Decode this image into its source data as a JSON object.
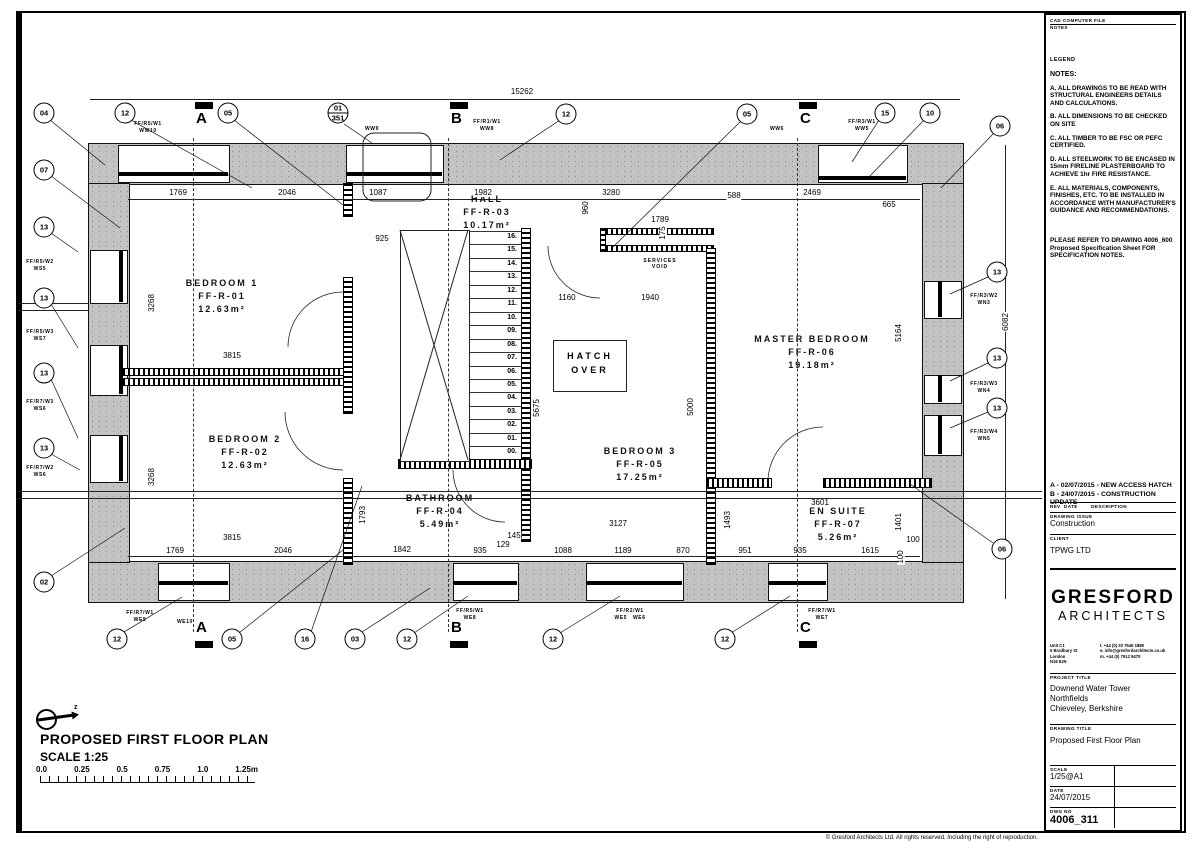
{
  "footer": "© Gresford Architects Ltd.  All rights reserved.  Including the right of reproduction.",
  "panel": {
    "file_label": "CAD COMPUTER FILE",
    "file_sub": "NOTES",
    "legend": "LEGEND",
    "notes_heading": "NOTES:",
    "notes": [
      "A. ALL DRAWINGS TO  BE READ WITH STRUCTURAL ENGINEERS DETAILS AND CALCULATIONS.",
      "B. ALL DIMENSIONS TO BE CHECKED ON SITE",
      "C. ALL TIMBER TO BE FSC OR PEFC CERTIFIED.",
      "D. ALL STEELWORK TO BE ENCASED IN 15mm FIRELINE PLASTERBOARD TO ACHIEVE 1hr FIRE RESISTANCE.",
      "E. ALL MATERIALS, COMPONENTS, FINISHES, ETC. TO BE INSTALLED IN ACCORDANCE WITH MANUFACTURER'S GUIDANCE AND RECOMMENDATIONS."
    ],
    "refer": "PLEASE REFER TO DRAWING 4006_600 Proposed Specification Sheet FOR SPECIFICATION NOTES.",
    "revisions": [
      "A - 02/07/2015 - NEW ACCESS HATCH",
      "B - 24/07/2015 - CONSTRUCTION  UPDATE"
    ],
    "rev_header": "REV  DATE        DESCRIPTION",
    "issue_label": "DRAWING ISSUE",
    "issue_value": "Construction",
    "client_label": "CLIENT",
    "client_value": "TPWG LTD",
    "brand_line1": "GRESFORD",
    "brand_line2": "ARCHITECTS",
    "address": [
      "Unit C1",
      "5 Bradbury St",
      "London",
      "N16 8JN"
    ],
    "contact": [
      "t.   +44 (0) 20 7549 1888",
      "e.   info@gresfordarchitects.co.uk",
      "m.  +44 (0) 7912 9470"
    ],
    "project_label": "PROJECT  TITLE",
    "project": [
      "Downend Water Tower",
      "Northfields",
      "Chieveley, Berkshire"
    ],
    "drawing_label": "DRAWING  TITLE",
    "drawing_value": "Proposed First Floor Plan",
    "scale_label": "SCALE",
    "scale_value": "1/25@A1",
    "drawn_label": "DRAWN",
    "drawn_value": "TG",
    "date_label": "DATE",
    "date_value": "24/07/2015",
    "checked_label": "CHECKED",
    "checked_value": "TG",
    "dwg_label": "DWG  NO",
    "dwg_value": "4006_311",
    "revision_label": "REVISION",
    "revision_value": "B"
  },
  "plan": {
    "title": "PROPOSED FIRST FLOOR PLAN",
    "scale": "SCALE 1:25",
    "scalebar": [
      "0.0",
      "0.25",
      "0.5",
      "0.75",
      "1.0",
      "1.25m"
    ],
    "hatch_over": [
      "HATCH",
      "OVER"
    ],
    "services_void": [
      "SERVICES",
      "VOID"
    ],
    "rooms": [
      {
        "name": "BEDROOM 1",
        "id": "FF-R-01",
        "area": "12.63m²",
        "x": 222,
        "y": 277
      },
      {
        "name": "BEDROOM 2",
        "id": "FF-R-02",
        "area": "12.63m²",
        "x": 245,
        "y": 433
      },
      {
        "name": "HALL",
        "id": "FF-R-03",
        "area": "10.17m²",
        "x": 487,
        "y": 193
      },
      {
        "name": "BATHROOM",
        "id": "FF-R-04",
        "area": "5.49m²",
        "x": 440,
        "y": 492
      },
      {
        "name": "BEDROOM 3",
        "id": "FF-R-05",
        "area": "17.25m²",
        "x": 640,
        "y": 445
      },
      {
        "name": "MASTER BEDROOM",
        "id": "FF-R-06",
        "area": "19.18m²",
        "x": 812,
        "y": 333
      },
      {
        "name": "EN SUITE",
        "id": "FF-R-07",
        "area": "5.26m²",
        "x": 838,
        "y": 505
      }
    ],
    "stairs": [
      "16.",
      "15.",
      "14.",
      "13.",
      "12.",
      "11.",
      "10.",
      "09.",
      "08.",
      "07.",
      "06.",
      "05.",
      "04.",
      "03.",
      "02.",
      "01.",
      "00."
    ],
    "dims": [
      {
        "v": "15262",
        "x": 522,
        "y": 92
      },
      {
        "v": "1769",
        "x": 178,
        "y": 193
      },
      {
        "v": "2046",
        "x": 287,
        "y": 193
      },
      {
        "v": "1087",
        "x": 378,
        "y": 193
      },
      {
        "v": "1982",
        "x": 483,
        "y": 193
      },
      {
        "v": "3280",
        "x": 611,
        "y": 193
      },
      {
        "v": "588",
        "x": 734,
        "y": 196
      },
      {
        "v": "2469",
        "x": 812,
        "y": 193
      },
      {
        "v": "665",
        "x": 889,
        "y": 205
      },
      {
        "v": "925",
        "x": 382,
        "y": 239
      },
      {
        "v": "1789",
        "x": 660,
        "y": 220
      },
      {
        "v": "1160",
        "x": 567,
        "y": 298
      },
      {
        "v": "1940",
        "x": 650,
        "y": 298
      },
      {
        "v": "3815",
        "x": 232,
        "y": 356
      },
      {
        "v": "3815",
        "x": 232,
        "y": 538
      },
      {
        "v": "1769",
        "x": 175,
        "y": 551
      },
      {
        "v": "2046",
        "x": 283,
        "y": 551
      },
      {
        "v": "1842",
        "x": 402,
        "y": 550
      },
      {
        "v": "935",
        "x": 480,
        "y": 551
      },
      {
        "v": "129",
        "x": 503,
        "y": 545
      },
      {
        "v": "145",
        "x": 514,
        "y": 536
      },
      {
        "v": "1088",
        "x": 563,
        "y": 551
      },
      {
        "v": "1189",
        "x": 623,
        "y": 551
      },
      {
        "v": "870",
        "x": 683,
        "y": 551
      },
      {
        "v": "3127",
        "x": 618,
        "y": 524
      },
      {
        "v": "3601",
        "x": 820,
        "y": 503
      },
      {
        "v": "951",
        "x": 745,
        "y": 551
      },
      {
        "v": "935",
        "x": 800,
        "y": 551
      },
      {
        "v": "1615",
        "x": 870,
        "y": 551
      },
      {
        "v": "100",
        "x": 913,
        "y": 540
      },
      {
        "v": "960",
        "x": 586,
        "y": 208,
        "r": 1
      },
      {
        "v": "175",
        "x": 663,
        "y": 233,
        "r": 1
      },
      {
        "v": "3268",
        "x": 152,
        "y": 303,
        "r": 1
      },
      {
        "v": "3268",
        "x": 152,
        "y": 477,
        "r": 1
      },
      {
        "v": "5675",
        "x": 537,
        "y": 408,
        "r": 1
      },
      {
        "v": "5000",
        "x": 691,
        "y": 407,
        "r": 1
      },
      {
        "v": "5164",
        "x": 899,
        "y": 333,
        "r": 1
      },
      {
        "v": "6082",
        "x": 1006,
        "y": 322,
        "r": 1
      },
      {
        "v": "1793",
        "x": 363,
        "y": 515,
        "r": 1
      },
      {
        "v": "1493",
        "x": 728,
        "y": 520,
        "r": 1
      },
      {
        "v": "1401",
        "x": 899,
        "y": 522,
        "r": 1
      },
      {
        "v": "100",
        "x": 901,
        "y": 557,
        "r": 1
      }
    ],
    "callouts": [
      {
        "t": "04",
        "x": 44,
        "y": 113
      },
      {
        "t": "12",
        "x": 125,
        "y": 113
      },
      {
        "t": "05",
        "x": 228,
        "y": 113
      },
      {
        "t": "01",
        "b": "351",
        "x": 338,
        "y": 113
      },
      {
        "t": "12",
        "x": 566,
        "y": 114
      },
      {
        "t": "05",
        "x": 747,
        "y": 114
      },
      {
        "t": "15",
        "x": 885,
        "y": 113
      },
      {
        "t": "10",
        "x": 930,
        "y": 113
      },
      {
        "t": "06",
        "x": 1000,
        "y": 126
      },
      {
        "t": "07",
        "x": 44,
        "y": 170
      },
      {
        "t": "13",
        "x": 44,
        "y": 227
      },
      {
        "t": "13",
        "x": 44,
        "y": 298
      },
      {
        "t": "13",
        "x": 44,
        "y": 373
      },
      {
        "t": "13",
        "x": 44,
        "y": 448
      },
      {
        "t": "02",
        "x": 44,
        "y": 582
      },
      {
        "t": "13",
        "x": 997,
        "y": 272
      },
      {
        "t": "13",
        "x": 997,
        "y": 358
      },
      {
        "t": "13",
        "x": 997,
        "y": 408
      },
      {
        "t": "06",
        "x": 1002,
        "y": 549
      },
      {
        "t": "12",
        "x": 117,
        "y": 639
      },
      {
        "t": "05",
        "x": 232,
        "y": 639
      },
      {
        "t": "16",
        "x": 305,
        "y": 639
      },
      {
        "t": "03",
        "x": 355,
        "y": 639
      },
      {
        "t": "12",
        "x": 407,
        "y": 639
      },
      {
        "t": "12",
        "x": 553,
        "y": 639
      },
      {
        "t": "12",
        "x": 725,
        "y": 639
      }
    ],
    "wall_tags": [
      {
        "l1": "FF/R5/W1",
        "l2": "WW10",
        "x": 148,
        "y": 121
      },
      {
        "l1": "WW9",
        "l2": "",
        "x": 372,
        "y": 126
      },
      {
        "l1": "FF/R1/W1",
        "l2": "WW8",
        "x": 487,
        "y": 119
      },
      {
        "l1": "WW6",
        "l2": "",
        "x": 777,
        "y": 126
      },
      {
        "l1": "FF/R3/W1",
        "l2": "WW5",
        "x": 862,
        "y": 119
      },
      {
        "l1": "FF/R5/W2",
        "l2": "WS5",
        "x": 40,
        "y": 259
      },
      {
        "l1": "FF/R5/W3",
        "l2": "WS7",
        "x": 40,
        "y": 329
      },
      {
        "l1": "FF/R7/W3",
        "l2": "WS6",
        "x": 40,
        "y": 399
      },
      {
        "l1": "FF/R7/W2",
        "l2": "WS6",
        "x": 40,
        "y": 465
      },
      {
        "l1": "FF/R7/W1",
        "l2": "WE9",
        "x": 140,
        "y": 610
      },
      {
        "l1": "WE10",
        "l2": "",
        "x": 185,
        "y": 619
      },
      {
        "l1": "FF/R5/W1",
        "l2": "WE8",
        "x": 470,
        "y": 608
      },
      {
        "l1": "FF/R2/W1",
        "l2": "WE5   WE6",
        "x": 630,
        "y": 608
      },
      {
        "l1": "FF/R7/W1",
        "l2": "WE7",
        "x": 822,
        "y": 608
      },
      {
        "l1": "FF/R3/W2",
        "l2": "WN3",
        "x": 984,
        "y": 293
      },
      {
        "l1": "FF/R3/W3",
        "l2": "WN4",
        "x": 984,
        "y": 381
      },
      {
        "l1": "FF/R3/W4",
        "l2": "WN5",
        "x": 984,
        "y": 429
      }
    ],
    "sections": [
      {
        "letter": "A",
        "x": 193
      },
      {
        "letter": "B",
        "x": 448
      },
      {
        "letter": "C",
        "x": 797
      }
    ],
    "leaders": [
      [
        50,
        120,
        105,
        165
      ],
      [
        131,
        120,
        252,
        188
      ],
      [
        234,
        120,
        343,
        205
      ],
      [
        344,
        124,
        372,
        143
      ],
      [
        560,
        120,
        500,
        160
      ],
      [
        741,
        121,
        612,
        248
      ],
      [
        879,
        120,
        852,
        162
      ],
      [
        924,
        120,
        868,
        178
      ],
      [
        994,
        133,
        941,
        188
      ],
      [
        51,
        176,
        120,
        228
      ],
      [
        51,
        233,
        78,
        252
      ],
      [
        51,
        304,
        78,
        348
      ],
      [
        51,
        379,
        78,
        438
      ],
      [
        51,
        454,
        80,
        470
      ],
      [
        51,
        576,
        125,
        528
      ],
      [
        988,
        277,
        950,
        294
      ],
      [
        988,
        363,
        950,
        381
      ],
      [
        988,
        412,
        950,
        428
      ],
      [
        993,
        543,
        910,
        484
      ],
      [
        124,
        632,
        182,
        597
      ],
      [
        239,
        633,
        343,
        550
      ],
      [
        311,
        632,
        362,
        486
      ],
      [
        362,
        632,
        430,
        588
      ],
      [
        414,
        633,
        468,
        596
      ],
      [
        560,
        633,
        620,
        596
      ],
      [
        731,
        633,
        790,
        596
      ]
    ]
  }
}
